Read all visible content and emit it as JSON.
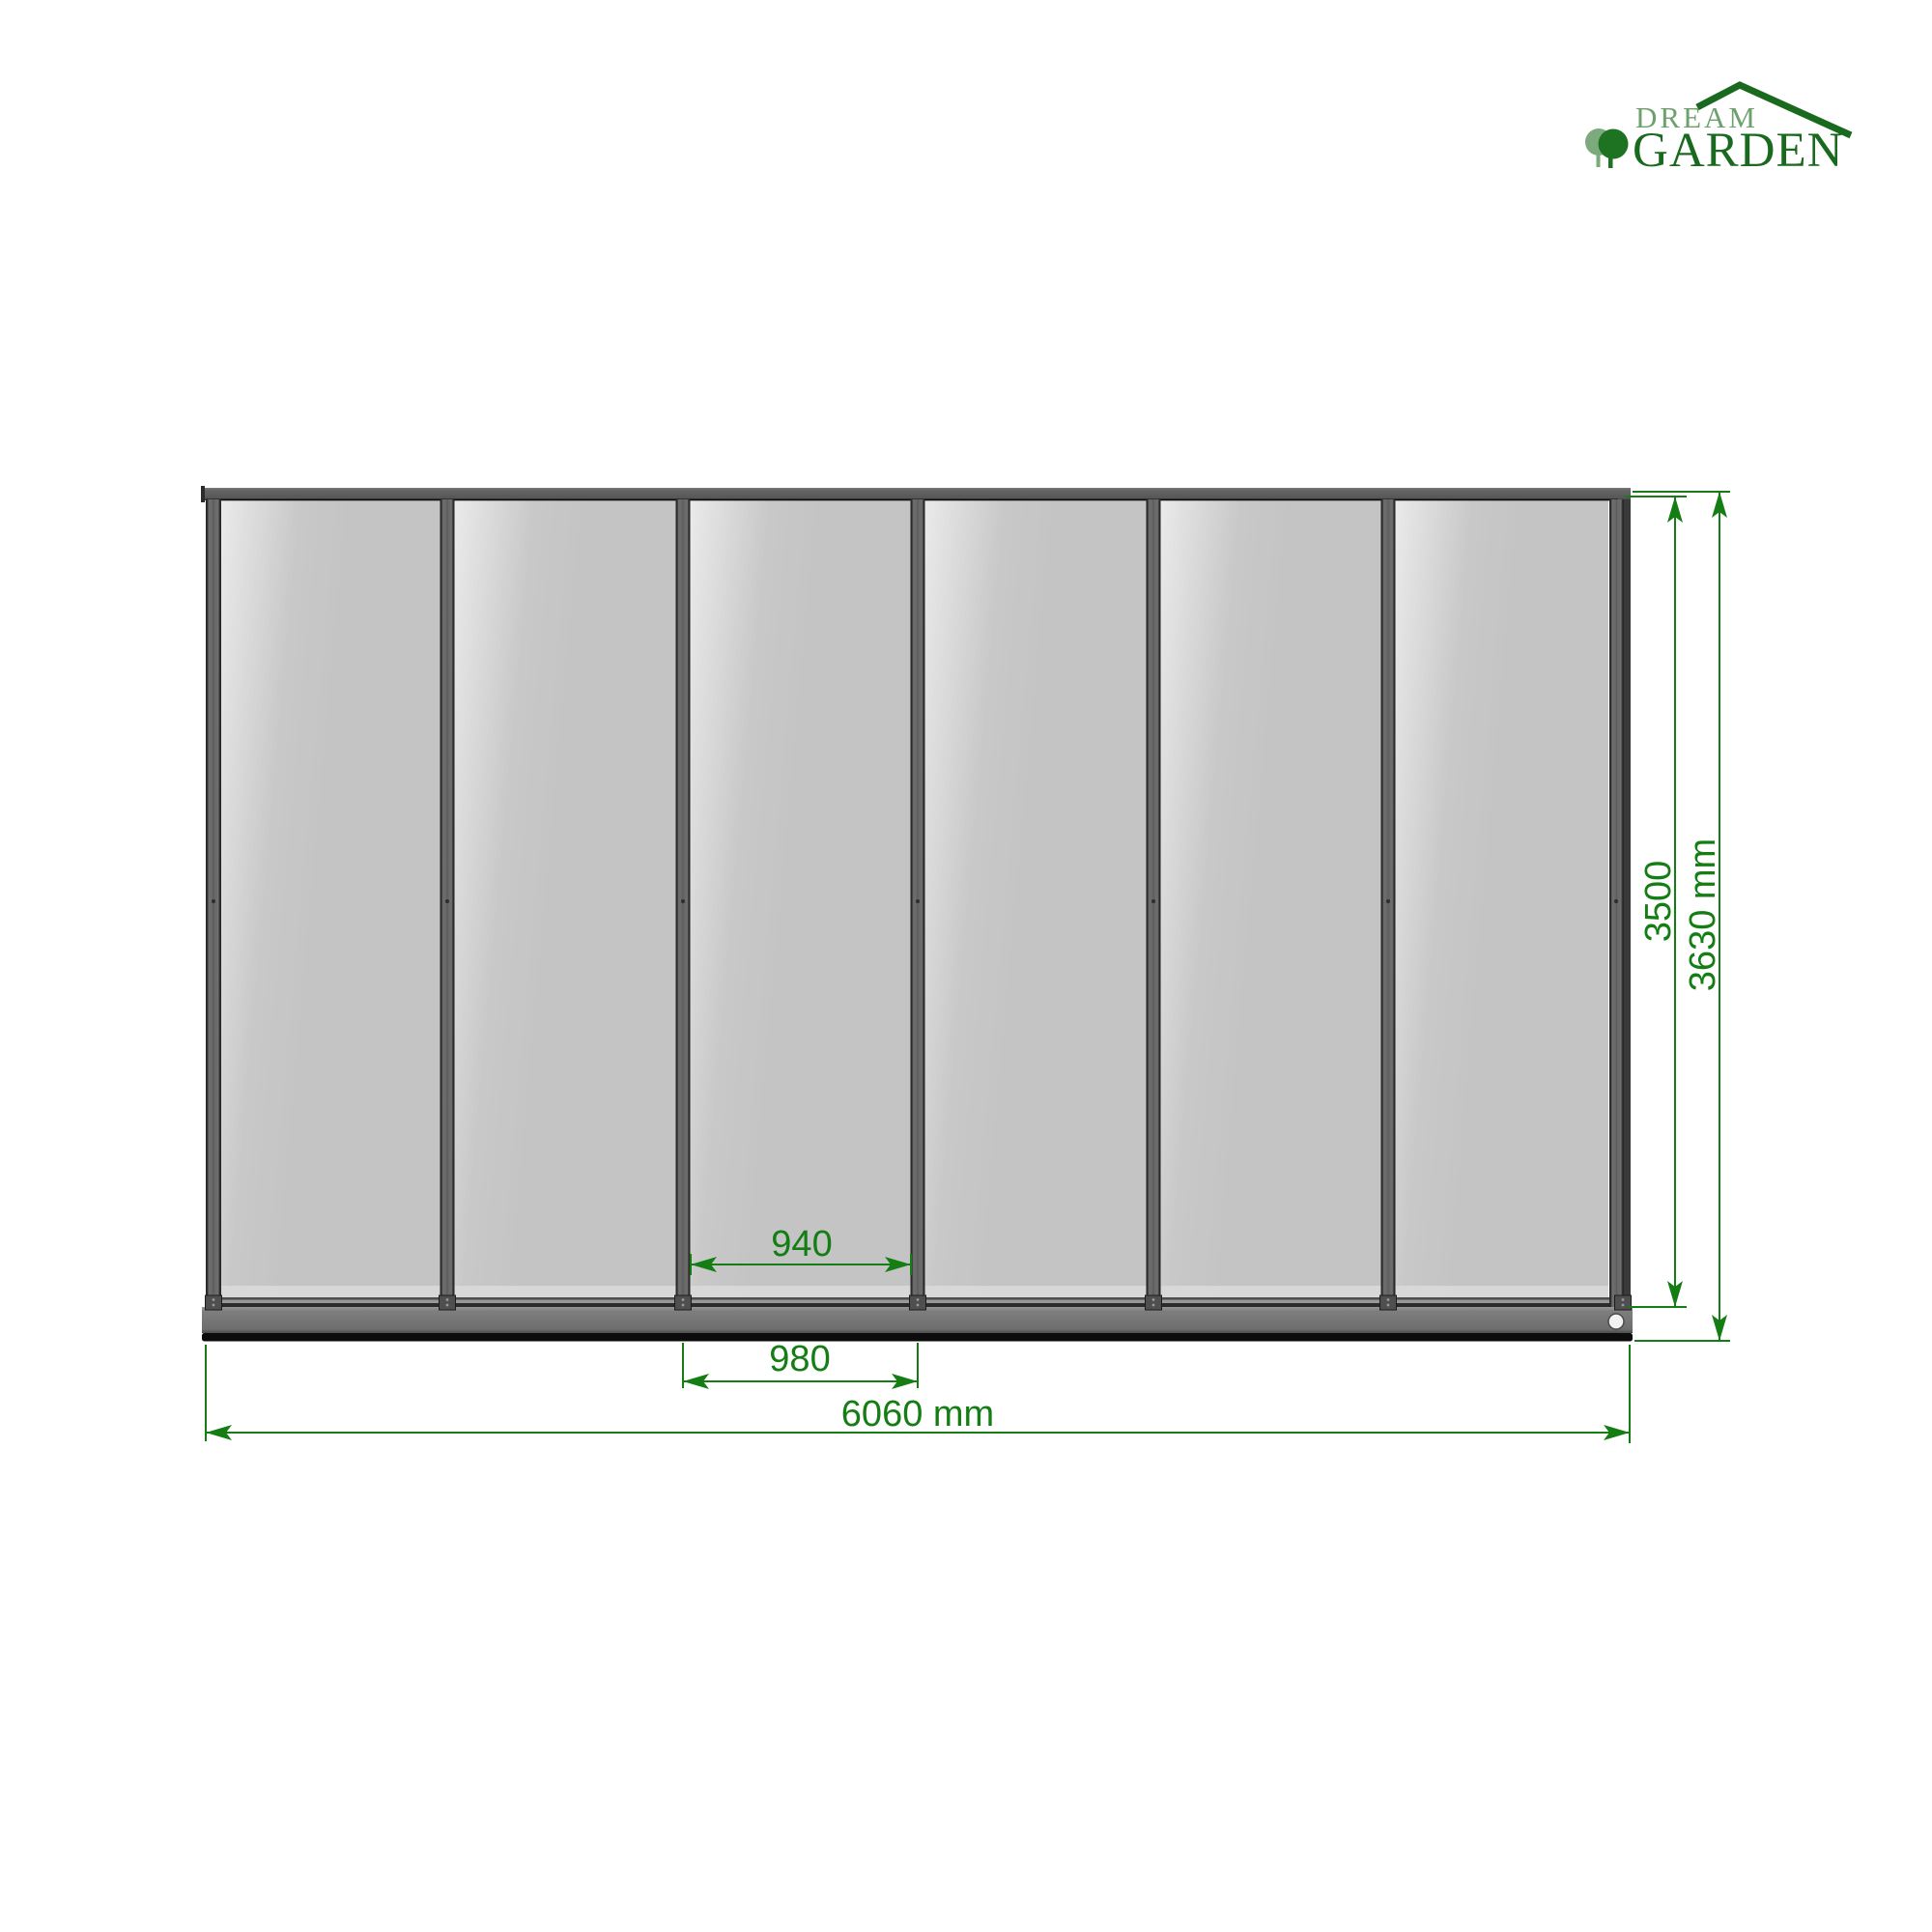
{
  "brand": {
    "name_top": "DREAM",
    "name_bottom": "GARDEN",
    "color_light_green": "#6ea06e",
    "color_dark_green": "#19691e"
  },
  "drawing": {
    "view": "front elevation of 6-panel glass wall",
    "panel_count": 6,
    "dimension_color": "#147d14",
    "frame_color": "#5e5e5e",
    "glass_color": "#c9c9c9",
    "labels": {
      "glass_panel_width": "940",
      "post_center_spacing": "980",
      "overall_width": "6060 mm",
      "frame_height": "3500",
      "overall_height": "3630 mm"
    }
  }
}
